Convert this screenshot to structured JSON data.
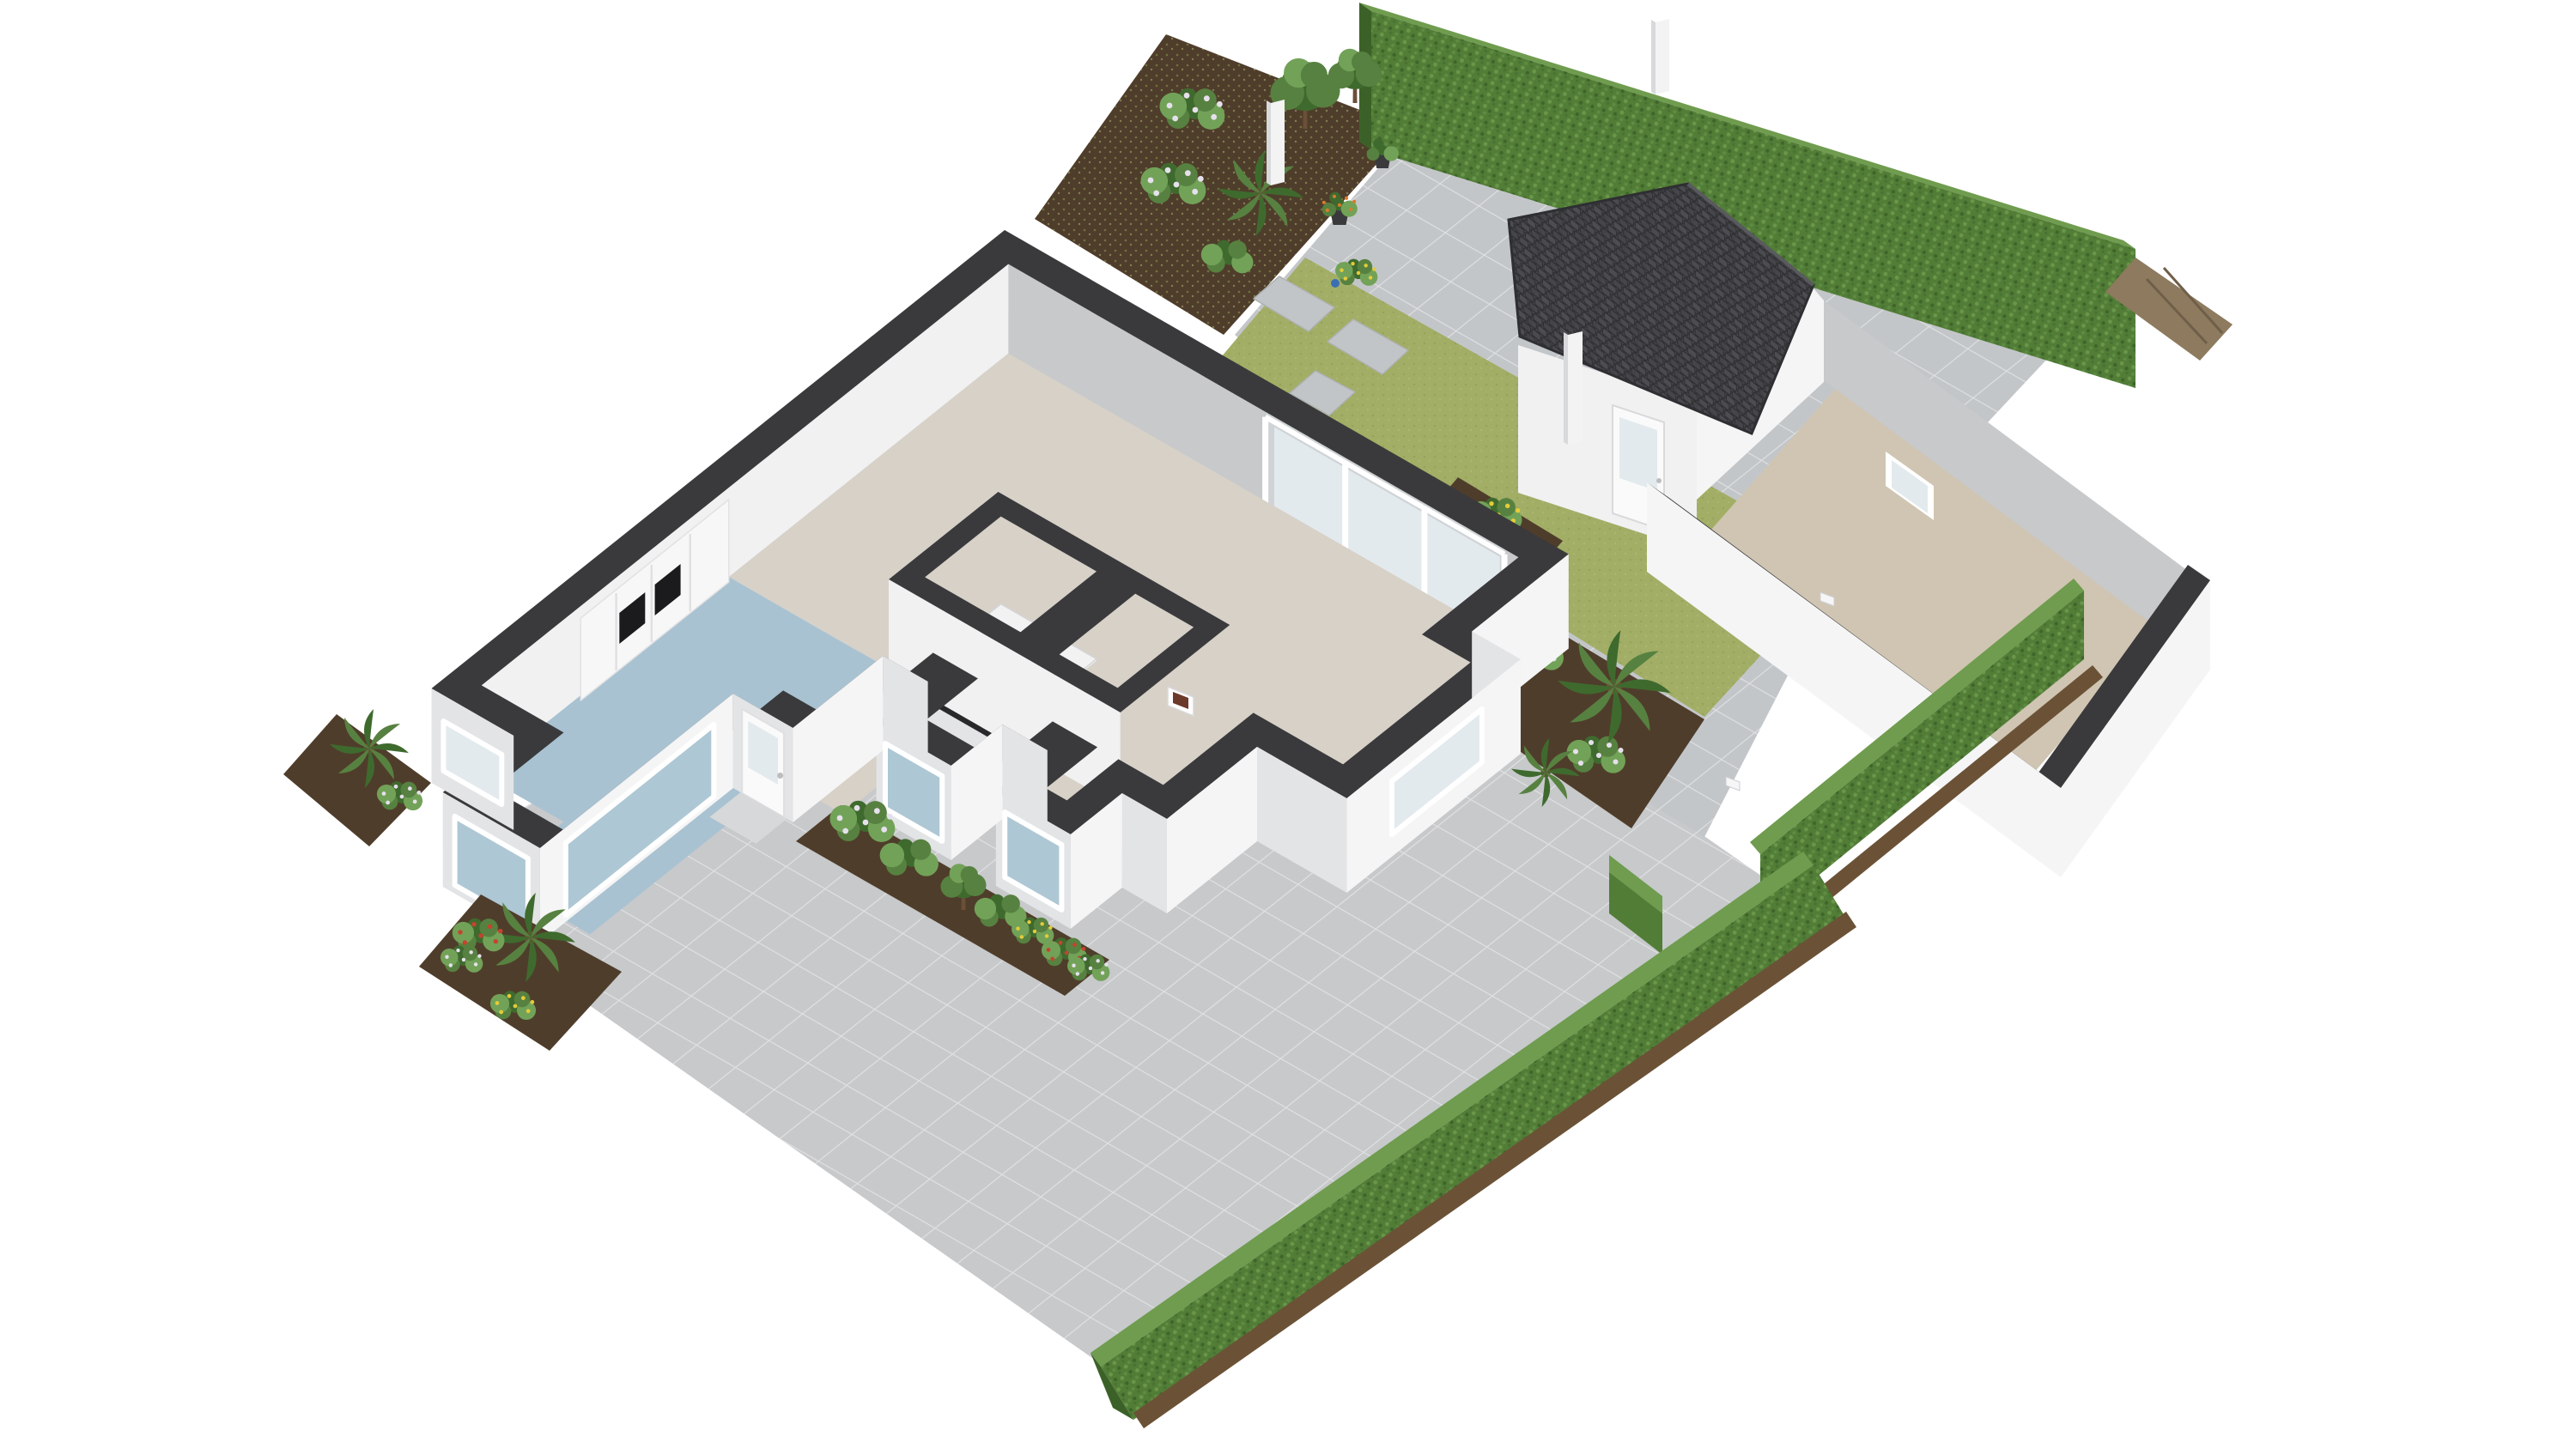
{
  "view": {
    "type": "isometric-3d-floorplan-render",
    "background": "#ffffff",
    "description": "ground-floor cutaway dollhouse view with garden, terrace and garage"
  },
  "palette": {
    "background": "#ffffff",
    "wall_cap": "#3a3a3c",
    "wall_exterior": "#f5f5f6",
    "wall_exterior_shaded": "#e3e4e6",
    "wall_interior_gray": "#c7c9cb",
    "wall_interior_white": "#f1f1f2",
    "floor_living": "#d7d1c8",
    "floor_kitchen": "#a9c2d1",
    "floor_garage": "#cfc5b2",
    "floor_stair": "#f2f2f3",
    "stair_step_alt": "#e7e7e9",
    "terrace": "#c7c9cb",
    "patio": "#c3c6c9",
    "tile_line": "#ffffff",
    "lawn": "#a2ae66",
    "hedge": "#527d37",
    "hedge_light": "#6f9c4e",
    "hedge_dark": "#3c6128",
    "soil": "#4f3d2b",
    "soil_light": "#6b5236",
    "stone": "#c2c5c7",
    "roof": "#464649",
    "roof_line": "#2e2f32",
    "wood_deck": "#8d7a5f",
    "glass": "#e3eaee",
    "glass_blue": "#aec7d4",
    "door_white": "#fafafa",
    "counter_dark": "#29292b",
    "appliance_black": "#1b1b1d",
    "post_white": "#f3f3f4",
    "post_shade": "#d8d9db",
    "plant_green_dark": "#3f6a2e",
    "plant_green": "#578140",
    "plant_green_light": "#72a258",
    "flower_white": "#e6e0ec",
    "flower_yellow": "#e5cb3a",
    "flower_red": "#c6432f",
    "flower_orange": "#d97a2c",
    "trunk_brown": "#6b4f37",
    "pot_dark": "#3a3a3c",
    "box_brown": "#6b3a2a"
  },
  "scene": {
    "objects": [
      {
        "name": "main-house"
      },
      {
        "name": "living-room-floor"
      },
      {
        "name": "hall-floor"
      },
      {
        "name": "kitchen-floor"
      },
      {
        "name": "winding-staircase"
      },
      {
        "name": "kitchen-counter-with-hob"
      },
      {
        "name": "oven-cabinet-column"
      },
      {
        "name": "sliding-glass-door"
      },
      {
        "name": "front-door"
      },
      {
        "name": "bay-windows"
      },
      {
        "name": "terrace-paving"
      },
      {
        "name": "courtyard-patio"
      },
      {
        "name": "garden-path"
      },
      {
        "name": "lawn-strip"
      },
      {
        "name": "stepping-stones"
      },
      {
        "name": "planting-beds"
      },
      {
        "name": "tall-boundary-hedge"
      },
      {
        "name": "garage-front-hedge"
      },
      {
        "name": "long-curved-hedge"
      },
      {
        "name": "garden-posts"
      },
      {
        "name": "garage"
      },
      {
        "name": "garage-pitched-roof"
      },
      {
        "name": "garage-floor"
      },
      {
        "name": "garage-side-door"
      },
      {
        "name": "palms-and-shrubs"
      },
      {
        "name": "flower-clusters"
      },
      {
        "name": "wooden-deck-strip"
      }
    ]
  }
}
